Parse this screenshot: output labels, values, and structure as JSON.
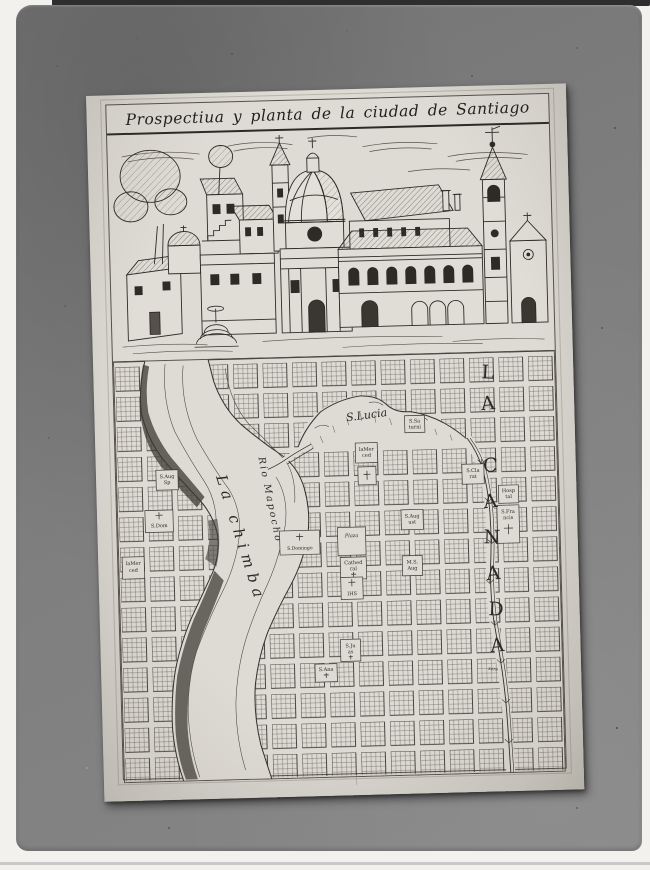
{
  "photo": {
    "mat_color": "#7d7d7d",
    "paper_color": "#dcd9d2",
    "ink_color": "#2e2b27"
  },
  "title": "Prospectiua y planta de la ciudad de Santiago",
  "map": {
    "hill_label": "S.Lucia",
    "river_label": "Rio Mapocho",
    "district_label": "La chimba",
    "avenue_letters": [
      "L",
      "A",
      "C",
      "A",
      "N",
      "A",
      "D",
      "A"
    ],
    "stream_note": "sere",
    "blocks": [
      {
        "name": "s-saturnina",
        "line1": "S.Sa",
        "line2": "turni"
      },
      {
        "name": "la-merced",
        "line1": "laMer",
        "line2": "ced"
      },
      {
        "name": "s-clara",
        "line1": "S.Cla",
        "line2": "rat"
      },
      {
        "name": "s-aug-west",
        "line1": "S.Aug",
        "line2": "Sp"
      },
      {
        "name": "s-dom-west",
        "line1": "S.Dom",
        "line2": ""
      },
      {
        "name": "merced-west",
        "line1": "laMer",
        "line2": "ced"
      },
      {
        "name": "s-domingo",
        "line1": "S.Domingo",
        "line2": ""
      },
      {
        "name": "plaza",
        "line1": "Plaza",
        "line2": ""
      },
      {
        "name": "cathedral",
        "line1": "Cathed",
        "line2": "ral"
      },
      {
        "name": "monjas-s-aug",
        "line1": "M.S.",
        "line2": "Aug"
      },
      {
        "name": "ihs",
        "line1": "IHS",
        "line2": ""
      },
      {
        "name": "s-augustin",
        "line1": "S.Aug",
        "line2": "ust"
      },
      {
        "name": "hospital",
        "line1": "Hosp",
        "line2": "tal"
      },
      {
        "name": "s-francisco",
        "line1": "S.Fra",
        "line2": "ncis"
      },
      {
        "name": "s-juan",
        "line1": "S.Ju",
        "line2": "as"
      },
      {
        "name": "s-ana",
        "line1": "S.Ana",
        "line2": ""
      }
    ]
  }
}
